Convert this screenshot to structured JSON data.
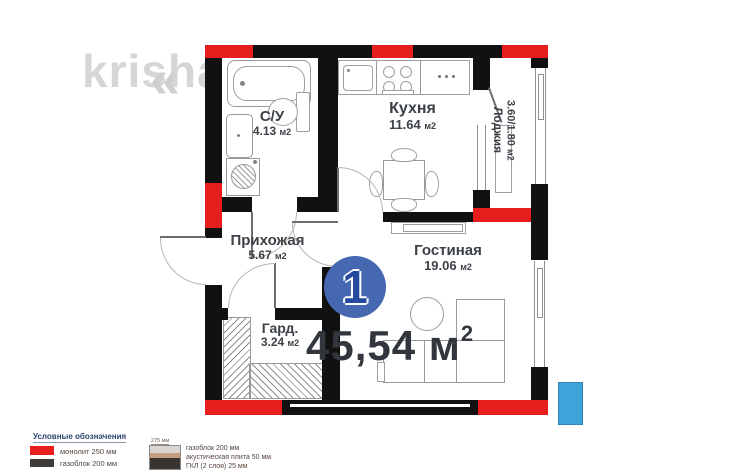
{
  "watermark": {
    "text": "krisha.k",
    "chevron": "«"
  },
  "unit": {
    "number": "1",
    "total_area_value": "45,54",
    "total_area_unit": "м",
    "total_area_sup": "2"
  },
  "rooms": {
    "bathroom": {
      "name": "С/У",
      "area": "4.13",
      "unit": "м2"
    },
    "kitchen": {
      "name": "Кухня",
      "area": "11.64",
      "unit": "м2"
    },
    "loggia": {
      "name": "Лоджия",
      "area": "3.60/1.80",
      "unit": "м2"
    },
    "hallway": {
      "name": "Прихожая",
      "area": "5.67",
      "unit": "м2"
    },
    "wardrobe": {
      "name": "Гард.",
      "area": "3.24",
      "unit": "м2"
    },
    "living": {
      "name": "Гостиная",
      "area": "19.06",
      "unit": "м2"
    }
  },
  "legend": {
    "title": "Условные обозначения",
    "items": [
      {
        "label": "монолит 250 мм",
        "color": "#e81e1e"
      },
      {
        "label": "газоблок 200 мм",
        "color": "#3e3b38"
      }
    ],
    "wall_stack": {
      "width_label": "275 мм",
      "lines": [
        "газоблок 200 мм",
        "акустическая плита 50 мм",
        "ГКЛ (2 слоя) 25 мм"
      ],
      "colors": [
        "#dad7d3",
        "#c59f7e",
        "#39342f"
      ]
    }
  },
  "colors": {
    "wall_black": "#111111",
    "wall_red": "#e81e1e",
    "unit_circle": "#4568b0",
    "unit_number": "#25499c",
    "marker_blue": "#3fa3da",
    "watermark_gray": "#d6d6d6"
  }
}
